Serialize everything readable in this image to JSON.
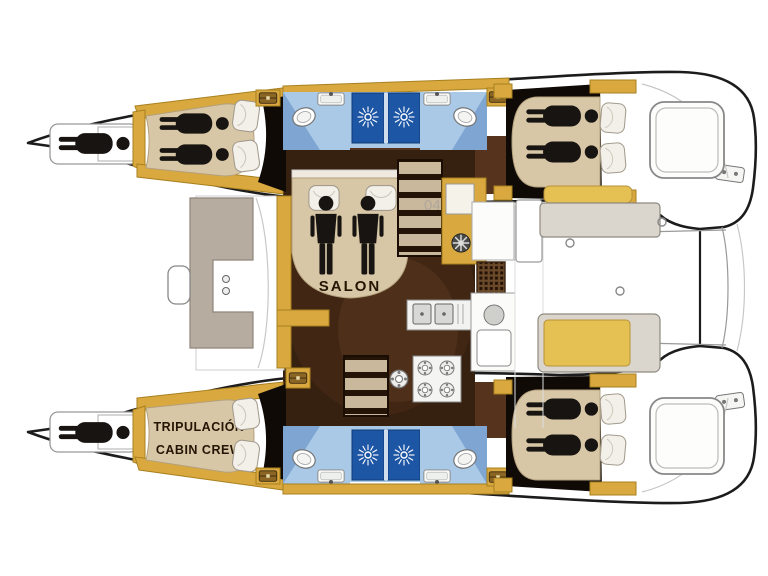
{
  "labels": {
    "salon": "SALON",
    "crew_line1": "TRIPULACIÓN",
    "crew_line2": "CABIN CREW",
    "watermark": "04"
  },
  "icons": {
    "shower_vent": "sunburst-fan",
    "storage_locker": "chest",
    "winch": "spoked-wheel",
    "berth_occupant": "lying-person",
    "salon_occupants": "standing-person-pair",
    "toilet": "oval-bowl",
    "stove": "four-burner",
    "sink": "basin"
  },
  "colors": {
    "hullStroke": "#1c1c1c",
    "wood": "#d9a93f",
    "woodStroke": "#a8801f",
    "bedBeige": "#d8c7a6",
    "bedBeigeStroke": "#b3a07c",
    "figureBlack": "#171411",
    "bathFloor": "#a9c9e6",
    "bathFloorDark": "#7fa6d2",
    "showerBlue": "#1d56a4",
    "floorDark": "#36200f",
    "floorMid": "#55331c",
    "cushion": "#e5c153",
    "cushionStroke": "#b8923a",
    "benchGray": "#dbd6cd",
    "benchStroke": "#8f8a80",
    "taupe": "#b7aca0",
    "lineGray": "#999999",
    "dark": "#100a06"
  }
}
